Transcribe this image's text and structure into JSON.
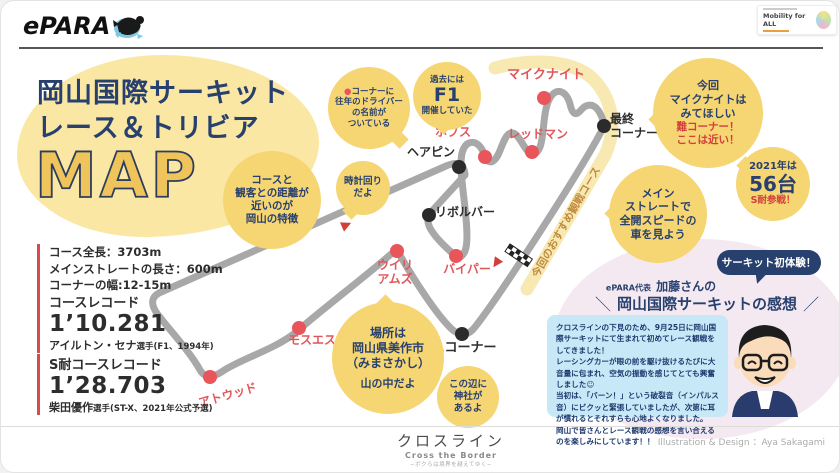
{
  "header": {
    "logo": "ePARA",
    "badge_title": "Mobility for ALL"
  },
  "title": {
    "line1": "岡山国際サーキット",
    "line2": "レース＆トリビア",
    "map_word": "MAP"
  },
  "specs": {
    "length": "コース全長：3703m",
    "straight": "メインストレートの長さ：600m",
    "corner_width": "コーナーの幅:12-15m"
  },
  "records": {
    "course": {
      "label": "コースレコード",
      "time": "1’10.281",
      "holder": "アイルトン・セナ",
      "detail": "選手(F1、1994年)"
    },
    "endurance": {
      "label": "S耐コースレコード",
      "time": "1’28.703",
      "holder": "柴田優作",
      "detail": "選手(ST-X、2021年公式予選)"
    }
  },
  "map": {
    "band_label": "今回のおすすめ観戦コース",
    "corners": {
      "mikeknight": "マイクナイト",
      "hobbs": "ホブス",
      "redman": "レッドマン",
      "last": "最終\nコーナー",
      "hairpin": "ヘアピン",
      "revolver": "リボルバー",
      "williams": "ウイリ\nアムズ",
      "piper": "バイパー",
      "moss": "モスエス",
      "atwood": "アトウッド",
      "first": "1コーナー"
    },
    "bubbles": {
      "drivers": {
        "dot": "●",
        "text": "コーナーに\n往年のドライバー\nの名前が\nついている"
      },
      "f1": {
        "top": "過去には",
        "big": "F1",
        "bottom": "開催していた"
      },
      "clockwise": "時計回り\nだよ",
      "distance": "コースと\n観客との距離が\n近いのが\n岡山の特徴",
      "mikeknight": {
        "navy": "今回\nマイクナイトは\nみてほしい",
        "red": "難コーナー！\nここは近い！"
      },
      "entries": {
        "top": "2021年は",
        "big": "56台",
        "red": "S耐参戦！"
      },
      "straight_view": "メイン\nストレートで\n全開スピードの\n車を見よう",
      "location": {
        "main": "場所は\n岡山県美作市\n（みまさかし）",
        "sub": "山の中だよ"
      },
      "shrine": "この辺に\n神社が\nあるよ"
    }
  },
  "voice": {
    "badge": "サーキット初体験！",
    "rep": "ePARA代表",
    "name": "加藤さんの",
    "slash_left": "＼",
    "slash_right": "／",
    "heading": "岡山国際サーキットの感想",
    "comment": "クロスラインの下見のため、9月25日に岡山国際サーキットにて生まれて初めてレース観戦をしてきました！\nレーシングカーが眼の前を駆け抜けるたびに大音量に包まれ、空気の振動を感じてとても興奮しました☺\n当初は、「バーン！」という破裂音（インパルス音）にビクッと緊張していましたが、次第に耳が慣れるとそれすらも心地よくなりました。\n岡山で皆さんとレース観戦の感想を言い合えるのを楽しみにしています！！"
  },
  "footer": {
    "brand_jp": "クロスライン",
    "brand_en": "Cross the Border",
    "tagline": "−ボクらは境界を越えてゆく−",
    "credit": "Illustration & Design ：Aya Sakagami"
  },
  "colors": {
    "navy": "#27406E",
    "corner_red": "#E0565A",
    "bubble_yellow": "#F6D573",
    "blob_yellow": "#FAE7A3",
    "track_gray": "#A8A8A8",
    "comment_blue": "#C7E9F7",
    "pink_blob": "#F5E9F1",
    "map_gold": "#EFC45B"
  }
}
